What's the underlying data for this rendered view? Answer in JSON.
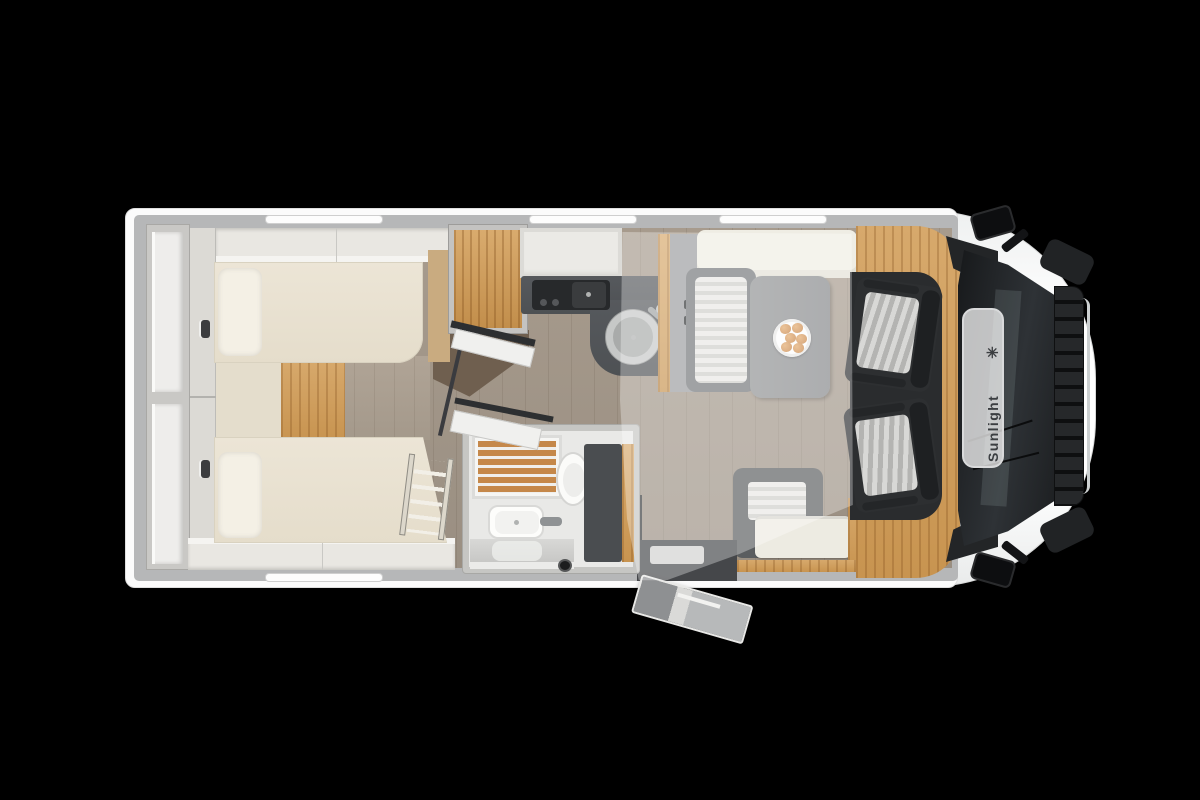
{
  "scene": {
    "kind": "motorhome-floorplan-top-view",
    "background_color": "#000000",
    "vehicle_facing": "right"
  },
  "brand": {
    "name": "Sunlight",
    "logo_glyph": "✳",
    "text_color": "#3b3e41"
  },
  "palette": {
    "body_white": "#fbfbfb",
    "wall_gray": "#b6b7b8",
    "floor_wood": "#a3988b",
    "oak_wood": "#d2a265",
    "teak_shower": "#c5884a",
    "counter_dark": "#54575a",
    "cab_floor_dark": "#2a2c2e",
    "seat_charcoal": "#2d2f31",
    "upholstery_cream": "#e9e2d2",
    "table_gray": "#8b8d8e",
    "overlay_bed": "rgba(255,255,255,0.32)"
  },
  "rooms": [
    {
      "id": "rear-bedroom",
      "label": "twin-single-beds-with-wardrobes"
    },
    {
      "id": "bathroom",
      "label": "shower-toilet-washbasin"
    },
    {
      "id": "kitchen",
      "label": "kitchenette-hob-sink-fridge"
    },
    {
      "id": "dinette",
      "label": "half-dinette-table-benches"
    },
    {
      "id": "cab",
      "label": "driver-cab-two-swivel-seats"
    },
    {
      "id": "drop-down-bed",
      "label": "translucent-drop-down-bed-overlay"
    },
    {
      "id": "entrance",
      "label": "entry-door-with-step"
    }
  ]
}
